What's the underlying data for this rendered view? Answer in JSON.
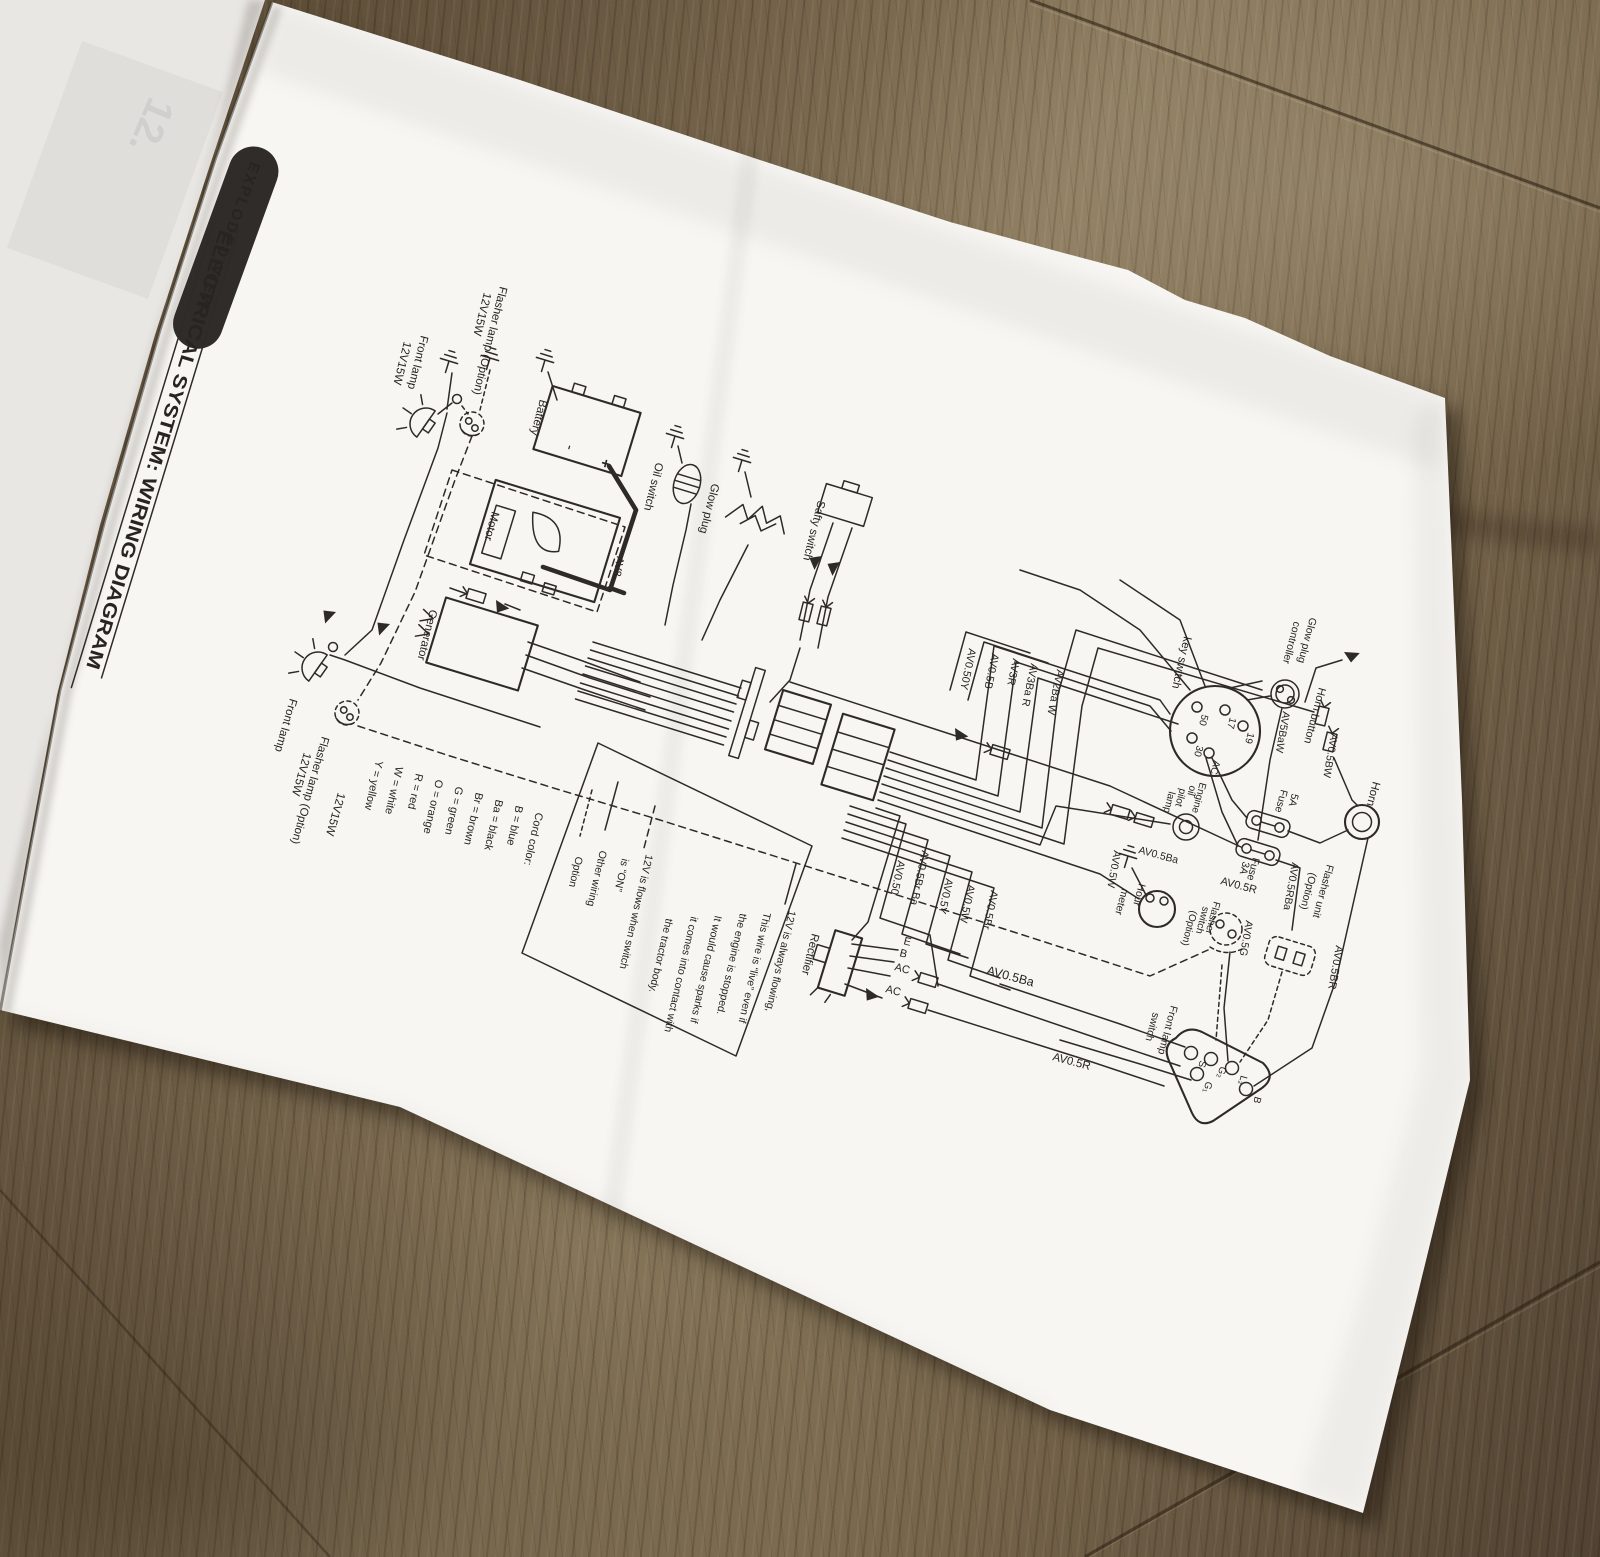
{
  "page": {
    "badge": "EXPLODED VIEW",
    "title": "ELECTRICAL SYSTEM: WIRING DIAGRAM",
    "ghost": "12."
  },
  "colors": {
    "paper": "#f7f6f3",
    "ink": "#2e2b27",
    "wood": "#6d5c44",
    "badge_bg": "#2f2c29"
  },
  "diagram": {
    "components": {
      "flasher_top": [
        "Flasher lamp (Option)",
        "12V15W"
      ],
      "front_top": [
        "Front lamp",
        "12V15W"
      ],
      "battery": "Battery",
      "battery_minus": "-",
      "battery_plus": "+",
      "motor": "Motor",
      "av8": "AV8",
      "oil_switch": "Oil switch",
      "glow_plug": "Glow plug",
      "safty_switch": "Safty switch",
      "generator": "Generator",
      "front_low": [
        "Front lamp",
        "12V15W"
      ],
      "flasher_low": [
        "Flasher lamp (Option)",
        "12V15W"
      ],
      "key_switch": "key switch",
      "glow_controller": [
        "Glow plug",
        "controller"
      ],
      "av5baw": "AV5BaW",
      "horn_button": "Horn button",
      "av05bw": "AV0.5BW",
      "horn": "Horn",
      "fuse5": [
        "Fuse",
        "5A"
      ],
      "fuse3": [
        "Fuse",
        "3A"
      ],
      "engine_pilot": [
        "Engine",
        "oil",
        "pilot",
        "lamp"
      ],
      "av05ba_hour": "AV0.5Ba",
      "av05w": "AV0.5W",
      "hour_meter": [
        "Hour",
        "meter"
      ],
      "av05r_mid": "AV0.5R",
      "flasher_switch": [
        "Flasher",
        "switch",
        "(Option)"
      ],
      "av05g": "AV0.5G",
      "flasher_unit": [
        "Flasher unit",
        "(Option)"
      ],
      "av05rba": "AV0.5RBa",
      "av05br": "AV0.5BR",
      "front_lamp_switch": [
        "Front lamp",
        "switch"
      ],
      "av05r_bottom": "AV0.5R",
      "rectifier": "Rectifier",
      "av05ba_rect": "AV0.5Ba"
    },
    "key_terminals": [
      "50",
      "17",
      "19",
      "30",
      "AC"
    ],
    "front_switch_terminals": [
      "S",
      "G₂",
      "L₂",
      "G₁",
      "B"
    ],
    "rectifier_terminals": [
      "E",
      "B",
      "AC",
      "AC"
    ],
    "wire_labels_top": [
      "AV0.50Y",
      "AV0.5B",
      "AV3R",
      "AV3Ba R",
      "AV2Ba W"
    ],
    "wire_labels_bottom": [
      "AV0.50",
      "AV0.5Br Ba",
      "AV0.5Y",
      "AV0.5W",
      "AV0.5Br"
    ],
    "legend": {
      "always": [
        "12V is always flowing,",
        "This wire is “live” even if",
        "the engine is stopped.",
        "It would cause sparks if",
        "it comes into contact with",
        "the tractor body."
      ],
      "switched": [
        "12V is flows when switch",
        "is “ON”"
      ],
      "other": "Other wiring",
      "option": "Option"
    },
    "cord_colors": [
      "Cord color:",
      "B = blue",
      "Ba = black",
      "Br = brown",
      "G = green",
      "O = orange",
      "R = red",
      "W = white",
      "Y = yellow"
    ]
  }
}
